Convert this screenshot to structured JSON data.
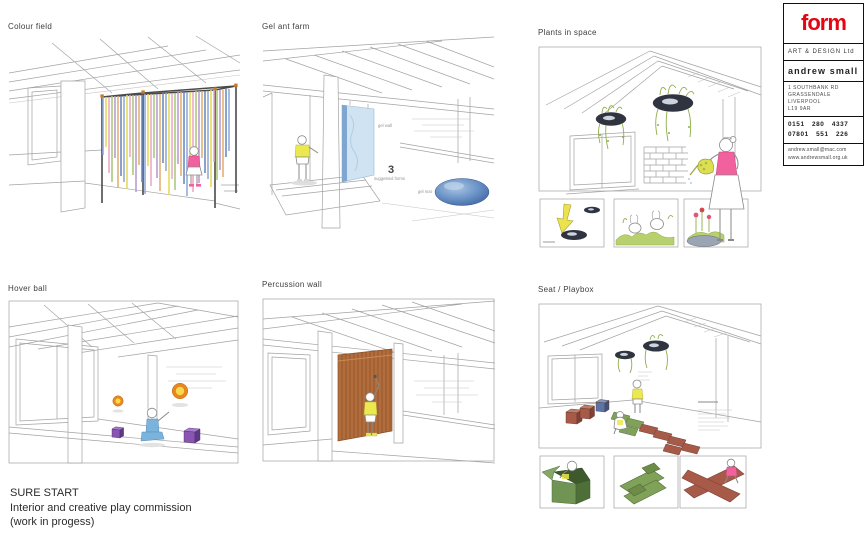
{
  "panels": [
    {
      "id": "colour-field",
      "title": "Colour field"
    },
    {
      "id": "gel-ant-farm",
      "title": "Gel ant farm",
      "annotations": {
        "gel_wall": "gel wall",
        "count": "3",
        "count_label": "suggested forms",
        "gel_mat": "gel mat"
      }
    },
    {
      "id": "plants-in-space",
      "title": "Plants in space"
    },
    {
      "id": "hover-ball",
      "title": "Hover ball"
    },
    {
      "id": "percussion-wall",
      "title": "Percussion wall"
    },
    {
      "id": "seat-playbox",
      "title": "Seat / Playbox"
    }
  ],
  "footer": {
    "title": "SURE START",
    "line2": "Interior and creative play commission",
    "line3": "(work in progess)"
  },
  "logo_card": {
    "brand": "form",
    "subtitle": "ART & DESIGN Ltd",
    "name": "andrew small",
    "address_lines": [
      "1 SOUTHBANK RD",
      "GRASSENDALE",
      "LIVERPOOL",
      "L19 9AR"
    ],
    "phone_lines": [
      "0151 280 4337",
      "07801 551 226"
    ],
    "contact_lines": [
      "andrew.small@mac.com",
      "www.andrewsmall.org.uk"
    ],
    "brand_color": "#e30613"
  },
  "palette": {
    "ribbons": [
      "#8fa8d8",
      "#e6da58",
      "#e9a8c0",
      "#a8c878",
      "#b89ad0",
      "#e0b070",
      "#6888c0"
    ],
    "gel_blue": "#4a72ae",
    "planter_dark": "#2f3440",
    "leaf_green": "#8fae4a",
    "hover_orange": "#e8871e",
    "cube_purple": "#8a55b0",
    "percussion_brown": "#b26d3c",
    "tile_green": "#7fa258",
    "tile_red": "#a85a48",
    "figure_pink": "#f0619e",
    "figure_yellow": "#ece84f",
    "figure_blue": "#7ab3dc"
  }
}
